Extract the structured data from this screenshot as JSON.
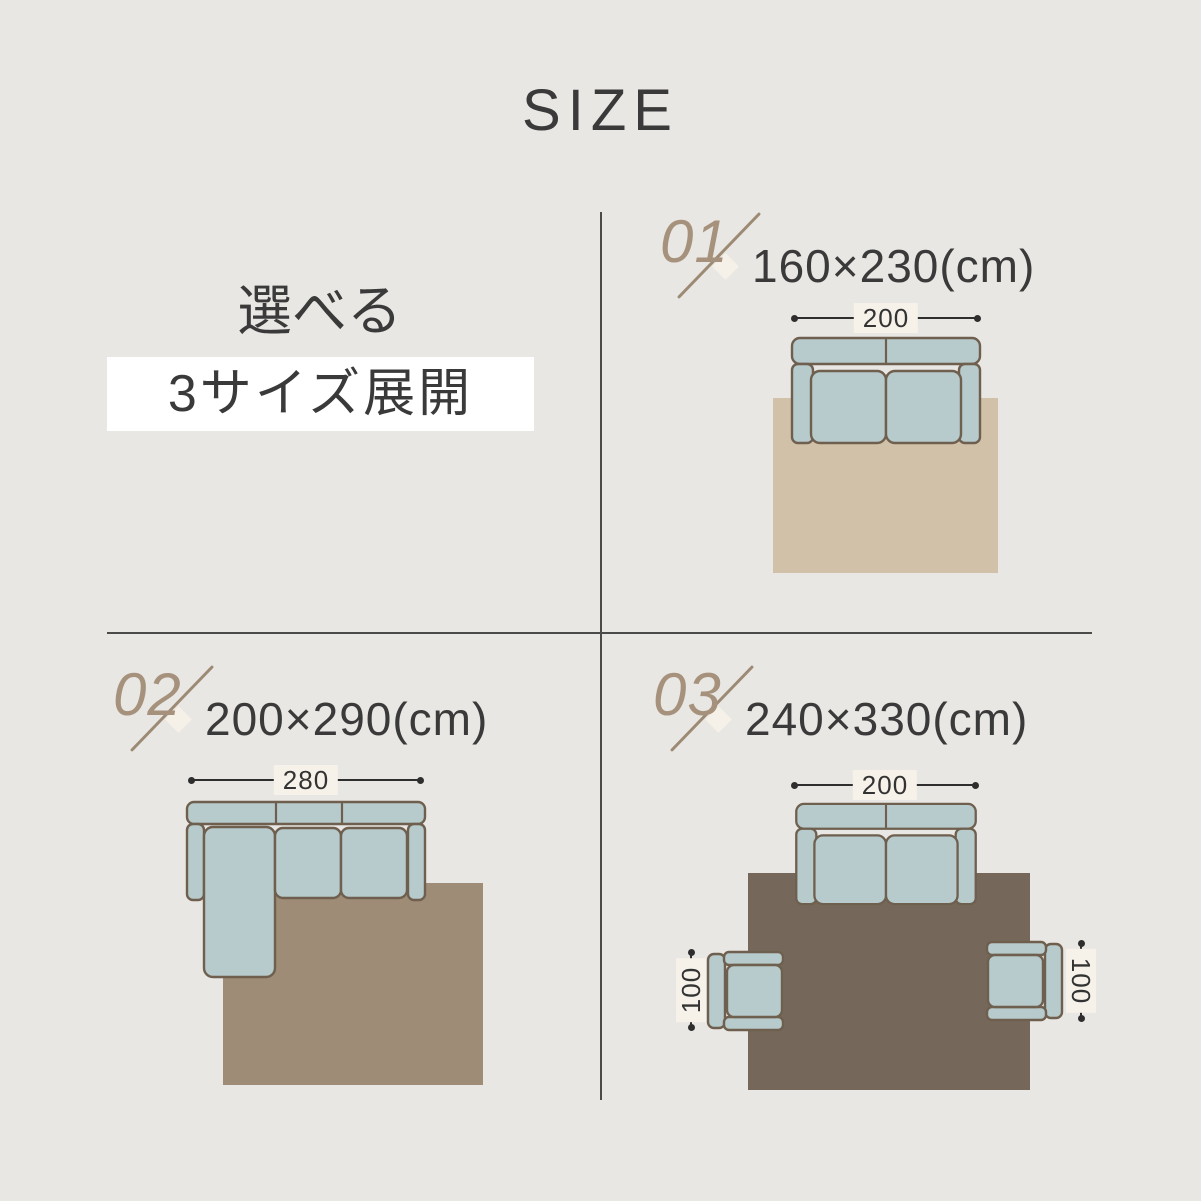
{
  "theme": {
    "bg": "#e9e7e3",
    "ink": "#3a3a3a",
    "accent": "#a6927c",
    "slash": "#9c8a74",
    "diamond": "#f5f1e8",
    "divider": "#4b4b49",
    "dim-line": "#2e2e2e",
    "label-bg": "#f6f2ea",
    "highlight-bg": "#ffffff",
    "sofa-fill": "#b7cacc",
    "sofa-stroke": "#6e5f4e",
    "rug-1": "#d2c1a9",
    "rug-2": "#9e8c76",
    "rug-3": "#75685a"
  },
  "header": {
    "title": "SIZE"
  },
  "tagline": {
    "line1": "選べる",
    "line2": "3サイズ展開"
  },
  "panels": [
    {
      "number": "01",
      "size_text": "160×230(cm)",
      "sofa_width": "200"
    },
    {
      "number": "02",
      "size_text": "200×290(cm)",
      "sofa_width": "280"
    },
    {
      "number": "03",
      "size_text": "240×330(cm)",
      "sofa_width": "200",
      "chair_width": "100"
    }
  ]
}
